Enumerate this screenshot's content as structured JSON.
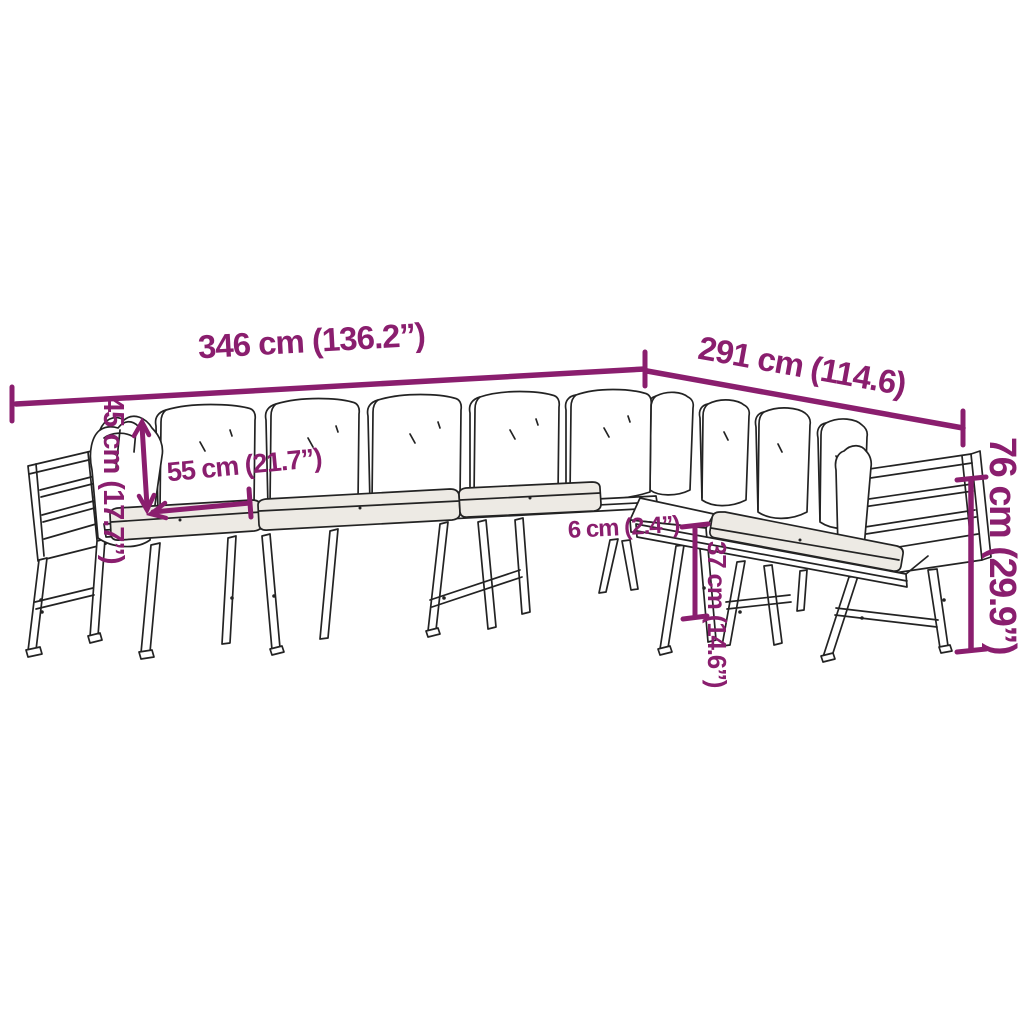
{
  "diagram": {
    "type": "product-dimension-sketch",
    "subject": "L-shaped garden sofa set line drawing",
    "measurements": {
      "main_length": "346 cm (136.2”)",
      "side_length": "291 cm (114.6)",
      "back_cushion_height": "45 cm (17.7”)",
      "seat_cushion_width": "55 cm (21.7”)",
      "frame_thickness": "6 cm (2.4”)",
      "underseat_clearance": "37 cm (14.6”)",
      "total_height": "76 cm (29.9”)"
    },
    "colors": {
      "dimension_accent": "#8a1e6e",
      "sketch_line": "#232323",
      "background": "#ffffff",
      "cushion_shade": "#edeae4"
    }
  }
}
